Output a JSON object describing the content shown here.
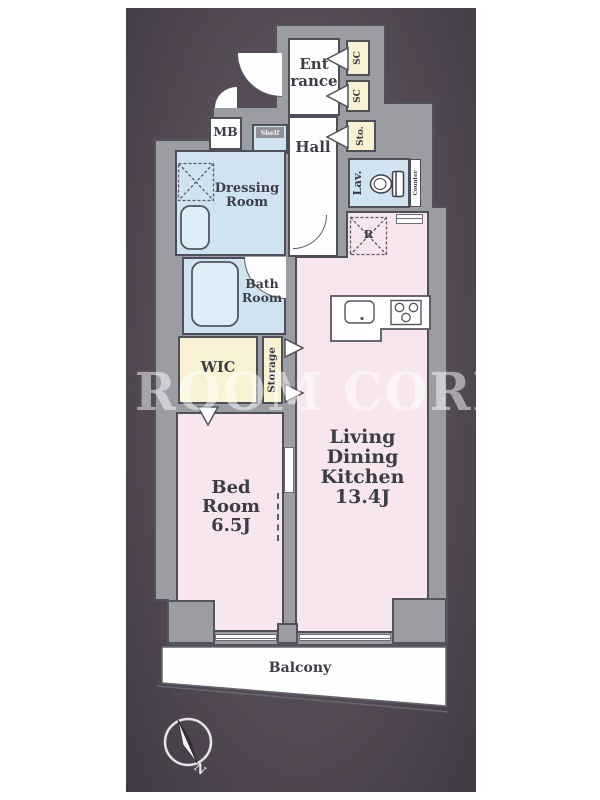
{
  "plan": {
    "watermark": "ROOM CORE",
    "rooms": {
      "entrance": "Ent\nrance",
      "hall": "Hall",
      "shoe_closet_upper": "SC",
      "shoe_closet_lower": "SC",
      "sto": "Sto.",
      "lavatory": "Lav.",
      "counter": "Counter",
      "meter_box": "MB",
      "shelf": "Shelf",
      "dressing_room": "Dressing\nRoom",
      "bath_room": "Bath\nRoom",
      "wic": "WIC",
      "storage": "Storage",
      "refrigerator": "R",
      "living_dining_kitchen": "Living\nDining\nKitchen\n13.4J",
      "bedroom": "Bed\nRoom\n6.5J",
      "balcony": "Balcony"
    },
    "compass": {
      "north": "N"
    },
    "colors": {
      "background": "#4e4450",
      "wall": "#9c9ca3",
      "outline": "#4f4f59",
      "room_pink": "#f8e6ef",
      "room_blue": "#cfe4f0",
      "room_yellow": "#f8f2d2",
      "room_white": "#fefefe"
    }
  }
}
